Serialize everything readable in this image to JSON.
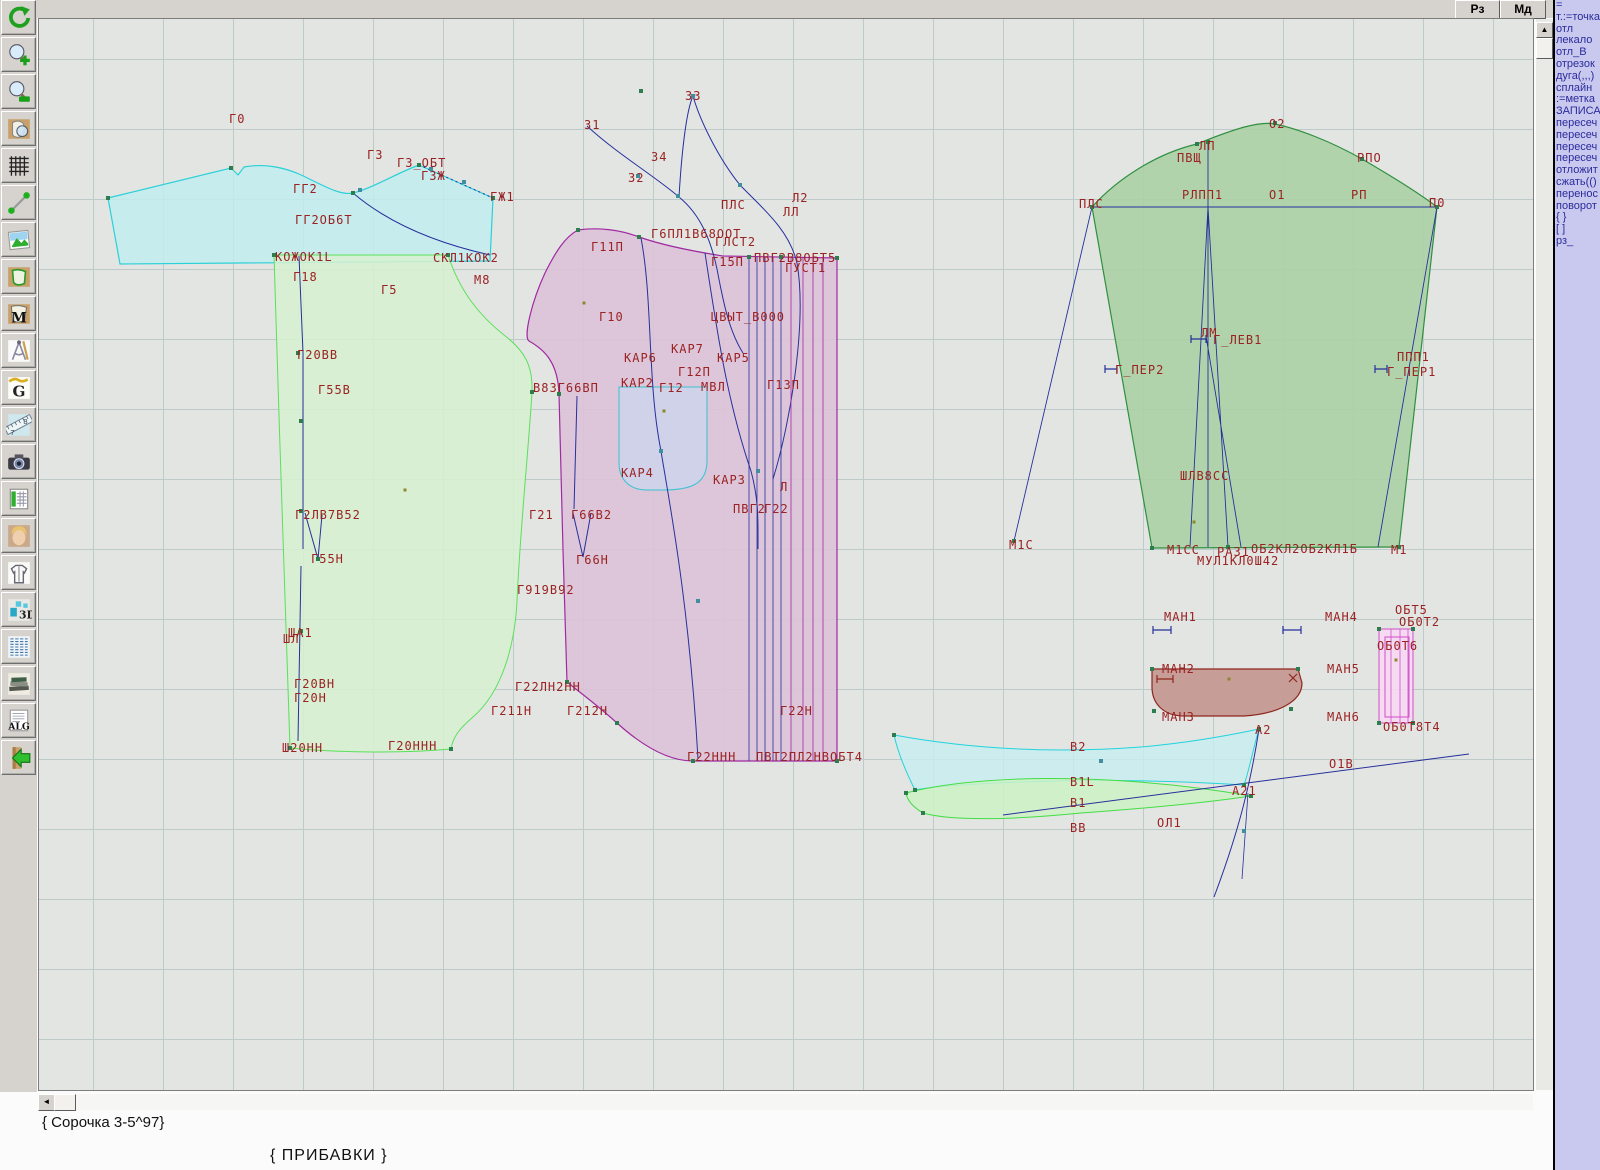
{
  "top_buttons": {
    "rz": "Рз",
    "md": "Мд"
  },
  "toolbar": {
    "icons": [
      "undo-icon",
      "zoom-in-icon",
      "zoom-out-icon",
      "piece-view-icon",
      "grid-icon",
      "segment-icon",
      "image-icon",
      "piece-green-icon",
      "piece-m-icon",
      "drafting-icon",
      "g-letter-icon",
      "ruler-icon",
      "camera-icon",
      "table-icon",
      "portrait-icon",
      "garment-icon",
      "3d-icon",
      "text-list-icon",
      "books-icon",
      "alg-icon",
      "exit-icon"
    ]
  },
  "right_panel": {
    "lines": [
      "=",
      "т.:=точка",
      "отл",
      "лекало",
      "отл_В",
      "отрезок",
      "дуга(,,,)",
      "сплайн",
      ":=метка",
      "ЗАПИСА",
      "пересеч",
      "пересеч",
      "пересеч",
      "пересеч",
      "отложит",
      "сжать(()",
      "перенос",
      "поворот",
      "{  }",
      "[  ]",
      "рз_"
    ]
  },
  "status": {
    "pattern_name": "{ Сорочка 3-5^97}",
    "note": "{  ПРИБАВКИ }"
  },
  "scrollbars": {
    "up_arrow": "▲",
    "left_arrow": "◄"
  },
  "canvas": {
    "grid_color": "#bccbca",
    "label_color": "#9b2222",
    "line_color": "#26309c",
    "piece_colors": {
      "yoke": "#c2edee",
      "back": "#d7f1d0",
      "front": "#dcc2d8",
      "sleeve": "#abd0a5",
      "cuff": "#c59a92",
      "facing_strips": "#f6d8f2",
      "collar": "#c5eef0",
      "collar_stand": "#cdf2c5",
      "pocket": "#cdd4ea"
    },
    "labels": [
      {
        "t": "Г0",
        "x": 228,
        "y": 122
      },
      {
        "t": "Г3",
        "x": 366,
        "y": 158
      },
      {
        "t": "Г3_ОБТ",
        "x": 396,
        "y": 166
      },
      {
        "t": "ГЗЖ",
        "x": 420,
        "y": 179
      },
      {
        "t": "ГГ2",
        "x": 292,
        "y": 192
      },
      {
        "t": "ГГ2ОБ6Т",
        "x": 294,
        "y": 223
      },
      {
        "t": "ГЖ1",
        "x": 489,
        "y": 200
      },
      {
        "t": "КОЖОК1L",
        "x": 274,
        "y": 260
      },
      {
        "t": "СКЛ1КОК2",
        "x": 432,
        "y": 261
      },
      {
        "t": "Г18",
        "x": 292,
        "y": 280
      },
      {
        "t": "Г5",
        "x": 380,
        "y": 293
      },
      {
        "t": "М8",
        "x": 473,
        "y": 283
      },
      {
        "t": "З3",
        "x": 684,
        "y": 99
      },
      {
        "t": "З1",
        "x": 583,
        "y": 128
      },
      {
        "t": "З4",
        "x": 650,
        "y": 160
      },
      {
        "t": "З2",
        "x": 627,
        "y": 181
      },
      {
        "t": "ПЛС",
        "x": 720,
        "y": 208
      },
      {
        "t": "Л2",
        "x": 791,
        "y": 201
      },
      {
        "t": "ЛЛ",
        "x": 782,
        "y": 215
      },
      {
        "t": "Г11П",
        "x": 590,
        "y": 250
      },
      {
        "t": "Г6ПЛ1В68ООТ",
        "x": 650,
        "y": 237
      },
      {
        "t": "ГЛСТ2",
        "x": 714,
        "y": 245
      },
      {
        "t": "Г15П",
        "x": 710,
        "y": 265
      },
      {
        "t": "ПВГ2В8ОБТ5",
        "x": 753,
        "y": 261
      },
      {
        "t": "ГУСТ1",
        "x": 784,
        "y": 271
      },
      {
        "t": "Г10",
        "x": 598,
        "y": 320
      },
      {
        "t": "ЦВЫТ_В000",
        "x": 710,
        "y": 320
      },
      {
        "t": "КАР7",
        "x": 670,
        "y": 352
      },
      {
        "t": "КАР6",
        "x": 623,
        "y": 361
      },
      {
        "t": "КАР5",
        "x": 716,
        "y": 361
      },
      {
        "t": "Г12П",
        "x": 677,
        "y": 375
      },
      {
        "t": "КАР2",
        "x": 620,
        "y": 386
      },
      {
        "t": "Г12",
        "x": 658,
        "y": 391
      },
      {
        "t": "МВЛ",
        "x": 700,
        "y": 390
      },
      {
        "t": "Г13П",
        "x": 766,
        "y": 388
      },
      {
        "t": "КАР4",
        "x": 620,
        "y": 476
      },
      {
        "t": "КАР3",
        "x": 712,
        "y": 483
      },
      {
        "t": "Л",
        "x": 779,
        "y": 490
      },
      {
        "t": "ПВГ2",
        "x": 732,
        "y": 512
      },
      {
        "t": "Г22",
        "x": 763,
        "y": 512
      },
      {
        "t": "Г21",
        "x": 528,
        "y": 518
      },
      {
        "t": "Г66В2",
        "x": 570,
        "y": 518
      },
      {
        "t": "Г66Н",
        "x": 575,
        "y": 563
      },
      {
        "t": "Г919В92",
        "x": 516,
        "y": 593
      },
      {
        "t": "Г22ЛН2НН",
        "x": 514,
        "y": 690
      },
      {
        "t": "Г211Н",
        "x": 490,
        "y": 714
      },
      {
        "t": "Г212Н",
        "x": 566,
        "y": 714
      },
      {
        "t": "Г22Н",
        "x": 779,
        "y": 714
      },
      {
        "t": "Г22ННН",
        "x": 686,
        "y": 760
      },
      {
        "t": "ПВТ2ПЛ2НВОБТ4",
        "x": 755,
        "y": 760
      },
      {
        "t": "Г20ВВ",
        "x": 296,
        "y": 358
      },
      {
        "t": "Г55В",
        "x": 317,
        "y": 393
      },
      {
        "t": "В8ЗГ66ВП",
        "x": 532,
        "y": 391
      },
      {
        "t": "Г2ЛВ7В52",
        "x": 294,
        "y": 518
      },
      {
        "t": "Г55Н",
        "x": 310,
        "y": 562
      },
      {
        "t": "ША1",
        "x": 287,
        "y": 636
      },
      {
        "t": "ШЛ",
        "x": 282,
        "y": 642
      },
      {
        "t": "Г20ВН",
        "x": 293,
        "y": 687
      },
      {
        "t": "Г20Н",
        "x": 293,
        "y": 701
      },
      {
        "t": "Ш20НН",
        "x": 281,
        "y": 751
      },
      {
        "t": "Г20ННН",
        "x": 387,
        "y": 749
      },
      {
        "t": "О2",
        "x": 1268,
        "y": 127
      },
      {
        "t": "ЛП",
        "x": 1198,
        "y": 149
      },
      {
        "t": "ПВЩ",
        "x": 1176,
        "y": 161
      },
      {
        "t": "РПО",
        "x": 1356,
        "y": 161
      },
      {
        "t": "РЛПП1",
        "x": 1181,
        "y": 198
      },
      {
        "t": "О1",
        "x": 1268,
        "y": 198
      },
      {
        "t": "РП",
        "x": 1350,
        "y": 198
      },
      {
        "t": "ПЛС",
        "x": 1078,
        "y": 207
      },
      {
        "t": "П0",
        "x": 1428,
        "y": 206
      },
      {
        "t": "ЛМ",
        "x": 1200,
        "y": 336
      },
      {
        "t": "Г_ЛЕВ1",
        "x": 1212,
        "y": 343
      },
      {
        "t": "Г_ПЕР2",
        "x": 1114,
        "y": 373
      },
      {
        "t": "ППП1",
        "x": 1396,
        "y": 360
      },
      {
        "t": "Г_ПЕР1",
        "x": 1386,
        "y": 375
      },
      {
        "t": "ШЛВ8СС",
        "x": 1179,
        "y": 479
      },
      {
        "t": "М1С",
        "x": 1008,
        "y": 548
      },
      {
        "t": "М1СС",
        "x": 1166,
        "y": 553
      },
      {
        "t": "РАЗ1",
        "x": 1216,
        "y": 555
      },
      {
        "t": "ОБ2КЛ2ОБ2КЛ1Б",
        "x": 1250,
        "y": 552
      },
      {
        "t": "М1",
        "x": 1390,
        "y": 553
      },
      {
        "t": "МУЛ1КЛ0Ш42",
        "x": 1196,
        "y": 564
      },
      {
        "t": "МАН1",
        "x": 1163,
        "y": 620
      },
      {
        "t": "МАН4",
        "x": 1324,
        "y": 620
      },
      {
        "t": "МАН2",
        "x": 1161,
        "y": 672
      },
      {
        "t": "МАН5",
        "x": 1326,
        "y": 672
      },
      {
        "t": "МАН3",
        "x": 1161,
        "y": 720
      },
      {
        "t": "МАН6",
        "x": 1326,
        "y": 720
      },
      {
        "t": "А2",
        "x": 1254,
        "y": 733
      },
      {
        "t": "ОБТ5",
        "x": 1394,
        "y": 613
      },
      {
        "t": "ОБ0Т2",
        "x": 1398,
        "y": 625
      },
      {
        "t": "ОБ0Т6",
        "x": 1376,
        "y": 649
      },
      {
        "t": "ОБ0Т8Т4",
        "x": 1382,
        "y": 730
      },
      {
        "t": "В2",
        "x": 1069,
        "y": 750
      },
      {
        "t": "В1L",
        "x": 1069,
        "y": 785
      },
      {
        "t": "В1",
        "x": 1069,
        "y": 806
      },
      {
        "t": "ВВ",
        "x": 1069,
        "y": 831
      },
      {
        "t": "ОЛ1",
        "x": 1156,
        "y": 826
      },
      {
        "t": "А21",
        "x": 1231,
        "y": 794
      },
      {
        "t": "О1В",
        "x": 1328,
        "y": 767
      }
    ]
  }
}
